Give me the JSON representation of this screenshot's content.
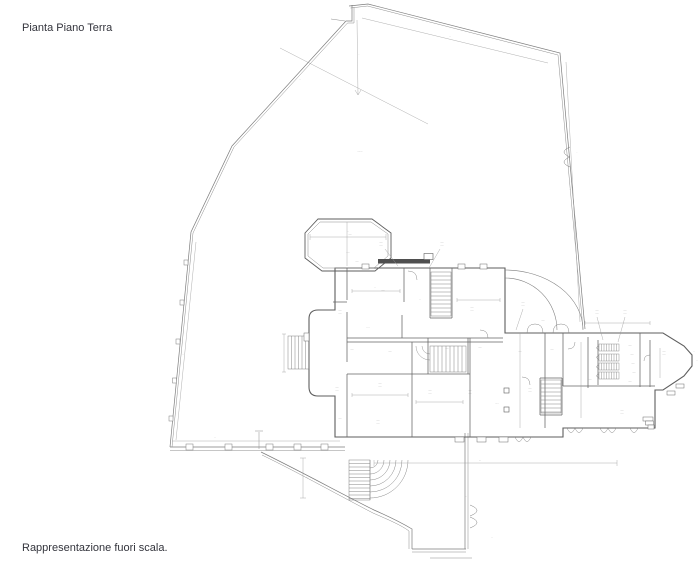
{
  "header": {
    "title": "Pianta Piano Terra"
  },
  "footer": {
    "note": "Rappresentazione fuori scala."
  },
  "drawing": {
    "kind": "architectural-ground-floor-plan",
    "ink": "#6b6b6b",
    "thin": "#9a9a9a",
    "label_ink": "#555555",
    "width": 700,
    "height": 567,
    "elements": [
      {
        "type": "pl",
        "p": "349,6 368,4 560,53 585,329",
        "w": 0.7,
        "c": "#7d7d7d"
      },
      {
        "type": "pl",
        "p": "350.5,8 367.5,6 558,55 583,329",
        "w": 0.5,
        "c": "#8d8d8d"
      },
      {
        "type": "pl",
        "p": "352,5 352,21 346,21 232,146 191,232 170,447",
        "w": 0.7,
        "c": "#7d7d7d"
      },
      {
        "type": "pl",
        "p": "354,7 354,23 347.5,23 234,147 193,233 172,447",
        "w": 0.5,
        "c": "#8d8d8d"
      },
      {
        "type": "pl",
        "p": "170,447 345,447",
        "w": 0.7,
        "c": "#7d7d7d"
      },
      {
        "type": "pl",
        "p": "170,450.5 345,450.5",
        "w": 0.5,
        "c": "#8d8d8d"
      },
      {
        "type": "pl",
        "p": "331,19 345,21",
        "w": 0.5,
        "c": "#8d8d8d"
      },
      {
        "type": "pl",
        "p": "465,433 465,549",
        "w": 0.7,
        "c": "#7d7d7d"
      },
      {
        "type": "pl",
        "p": "468,433 468,549",
        "w": 0.5,
        "c": "#8d8d8d"
      },
      {
        "type": "pl",
        "p": "412,549 466,549",
        "w": 0.7,
        "c": "#7d7d7d"
      },
      {
        "type": "pl",
        "p": "412,552 466,552",
        "w": 0.5,
        "c": "#8d8d8d"
      },
      {
        "type": "pl",
        "p": "430,558 472,558",
        "w": 0.5,
        "c": "#8d8d8d"
      },
      {
        "type": "pl",
        "p": "259,432 259,449",
        "w": 0.5,
        "c": "#8d8d8d"
      },
      {
        "type": "pl",
        "p": "255,431 263,431",
        "w": 0.5,
        "c": "#8d8d8d"
      },
      {
        "type": "pa",
        "d": "M261,452 C300,471 342,494 374,510 C390,517 402,523 412,529 L412,549",
        "w": 0.7,
        "c": "#7d7d7d"
      },
      {
        "type": "pa",
        "d": "M262,455 C301,474 342,497 373,513 C389,520 401,525 409,531 L409,549",
        "w": 0.5,
        "c": "#8d8d8d"
      },
      {
        "type": "pa",
        "d": "M570,147 Q558,152 570,157 M570,157 Q558,162 570,167",
        "w": 0.5,
        "c": "#7d7d7d"
      },
      {
        "type": "pa",
        "d": "M470,505 Q484,510.5 470,516 M470,517 Q484,522.5 470,528",
        "w": 0.5,
        "c": "#7d7d7d"
      },
      {
        "type": "r",
        "x": 184,
        "y": 260,
        "wd": 4,
        "ht": 5,
        "w": 0.5,
        "c": "#7d7d7d",
        "f": "#ffffff"
      },
      {
        "type": "r",
        "x": 180,
        "y": 300,
        "wd": 4,
        "ht": 5,
        "w": 0.5,
        "c": "#7d7d7d",
        "f": "#ffffff"
      },
      {
        "type": "r",
        "x": 176,
        "y": 339,
        "wd": 4,
        "ht": 5,
        "w": 0.5,
        "c": "#7d7d7d",
        "f": "#ffffff"
      },
      {
        "type": "r",
        "x": 172.5,
        "y": 378,
        "wd": 4,
        "ht": 5,
        "w": 0.5,
        "c": "#7d7d7d",
        "f": "#ffffff"
      },
      {
        "type": "r",
        "x": 169,
        "y": 416,
        "wd": 4,
        "ht": 5,
        "w": 0.5,
        "c": "#7d7d7d",
        "f": "#ffffff"
      },
      {
        "type": "r",
        "x": 186,
        "y": 444,
        "wd": 7,
        "ht": 6,
        "w": 0.5,
        "c": "#7d7d7d",
        "f": "#ffffff"
      },
      {
        "type": "r",
        "x": 225,
        "y": 444,
        "wd": 7,
        "ht": 6,
        "w": 0.5,
        "c": "#7d7d7d",
        "f": "#ffffff"
      },
      {
        "type": "r",
        "x": 266,
        "y": 444,
        "wd": 7,
        "ht": 6,
        "w": 0.5,
        "c": "#7d7d7d",
        "f": "#ffffff"
      },
      {
        "type": "r",
        "x": 294,
        "y": 444,
        "wd": 7,
        "ht": 6,
        "w": 0.5,
        "c": "#7d7d7d",
        "f": "#ffffff"
      },
      {
        "type": "r",
        "x": 321,
        "y": 444,
        "wd": 7,
        "ht": 6,
        "w": 0.5,
        "c": "#7d7d7d",
        "f": "#ffffff"
      },
      {
        "type": "pa",
        "d": "M335,268 L335,310 L318,310 Q309,310 309,319 L309,387 Q309,396 318,396 L335,396 L335,437 L563,437 L563,428 L655,428 L655,390 L663,390 L684,376 L692,366 L692,355 L684,346 L663,333 L505,333 L505,268 Z",
        "w": 1.1,
        "c": "#5e5e5e"
      },
      {
        "type": "pa",
        "d": "M318,219 L372,219 L391,233 L391,258 L375,271 L322,271 L305,258 L305,233 Z",
        "w": 0.9,
        "c": "#5e5e5e"
      },
      {
        "type": "pa",
        "d": "M320,222 L371,222 L388,234 L388,256 L374,268 L323,268 L308,256 L308,234 Z",
        "w": 0.5,
        "c": "#8d8d8d"
      },
      {
        "type": "r",
        "x": 378,
        "y": 259,
        "wd": 52,
        "ht": 4.5,
        "w": 0,
        "c": "none",
        "f": "#4f4f4f"
      },
      {
        "type": "r",
        "x": 424,
        "y": 253.5,
        "wd": 9,
        "ht": 6,
        "w": 0.6,
        "c": "#5e5e5e",
        "f": "#ffffff"
      },
      {
        "type": "pa",
        "d": "M347,268 L347,300 M347,312 L347,362 M347,374 L347,437 M404,268 L404,302 M402,315 L402,338 M430,268 L430,318 M452,268 L452,318 M430,318 L452,318 M428,338 L428,374 M468,338 L468,374 M412,342 L412,437 M470,338 L470,437 M545,333 L545,428 M563,333 L563,386 M588,337 L588,388 M598,340 L598,385 M640,333 L640,387 M650,340 L650,387 M347,338 L503,338 M347,342 L503,342 M333,302 L347,302 M347,374 L470,374 M563,386 L655,386 M540,378 L562,378 M540,415 L562,415 M540,378 L540,415 M562,378 L562,415",
        "w": 0.75,
        "c": "#666666"
      },
      {
        "type": "h",
        "x": 431,
        "y": 272,
        "wd": 20,
        "ht": 44,
        "s": 4,
        "dir": "h",
        "w": 0.45,
        "c": "#777777"
      },
      {
        "type": "h",
        "x": 430,
        "y": 346,
        "wd": 36,
        "ht": 26,
        "s": 4,
        "dir": "v",
        "w": 0.45,
        "c": "#777777"
      },
      {
        "type": "h",
        "x": 541,
        "y": 380,
        "wd": 20,
        "ht": 33,
        "s": 4,
        "dir": "h",
        "w": 0.45,
        "c": "#777777"
      },
      {
        "type": "h",
        "x": 288,
        "y": 336,
        "wd": 21,
        "ht": 33,
        "s": 3.5,
        "dir": "v",
        "w": 0.45,
        "c": "#777777"
      },
      {
        "type": "h",
        "x": 349,
        "y": 460,
        "wd": 21,
        "ht": 40,
        "s": 3.5,
        "dir": "h",
        "w": 0.45,
        "c": "#777777"
      },
      {
        "type": "h",
        "x": 599,
        "y": 344,
        "wd": 20,
        "ht": 7,
        "s": 2.5,
        "dir": "v",
        "w": 0.4,
        "c": "#777777"
      },
      {
        "type": "h",
        "x": 599,
        "y": 354,
        "wd": 20,
        "ht": 7,
        "s": 2.5,
        "dir": "v",
        "w": 0.4,
        "c": "#777777"
      },
      {
        "type": "h",
        "x": 599,
        "y": 363,
        "wd": 20,
        "ht": 7,
        "s": 2.5,
        "dir": "v",
        "w": 0.4,
        "c": "#777777"
      },
      {
        "type": "h",
        "x": 599,
        "y": 372,
        "wd": 20,
        "ht": 7,
        "s": 2.5,
        "dir": "v",
        "w": 0.4,
        "c": "#777777"
      },
      {
        "type": "pa",
        "d": "M370,468 A8,8 0 0 0 378,460 M370,474 A14,14 0 0 0 384,460 M370,480 A20,20 0 0 0 390,460 M370,486 A26,26 0 0 0 396,460 M370,492 A32,32 0 0 0 402,460 M370,498 A38,38 0 0 0 408,460 M370,460 L370,500",
        "w": 0.45,
        "c": "#7d7d7d"
      },
      {
        "type": "pa",
        "d": "M430,354 A8,8 0 0 1 422,346 M430,360 A14,14 0 0 1 416,346",
        "w": 0.4,
        "c": "#7d7d7d"
      },
      {
        "type": "pa",
        "d": "M505,270 A78,60 0 0 1 583,330 M505,278 A52,52 0 0 1 557,330",
        "w": 0.55,
        "c": "#7d7d7d"
      },
      {
        "type": "pa",
        "d": "M527,333 Q527,324 535,324 Q543,324 543,333 M553,333 Q553,324 561,324 Q569,324 569,333 M515,437 Q519,446 523,437 M523,437 Q527,446 531,437 M567,428 Q571,437 575,428 M575,428 Q579,437 583,428 M600,428 Q604,437 608,428 M608,428 Q612,437 616,428 M630,428 Q634,437 638,428 M408,271 Q417,271 417,280 M488,338 Q488,330 480,330 M530,385 Q530,377 522,377 M650,355 Q644,355 644,361 M575,342 Q575,349 568,349 M599,346 Q594,347.5 599,350 M599,355.5 Q594,357 599,359.5 M599,365 Q594,366.5 599,369 M599,374 Q594,375.5 599,378",
        "w": 0.45,
        "c": "#7d7d7d"
      },
      {
        "type": "r",
        "x": 504,
        "y": 388,
        "wd": 5,
        "ht": 5,
        "w": 0.6,
        "c": "#5e5e5e",
        "f": "#ffffff"
      },
      {
        "type": "r",
        "x": 504,
        "y": 407,
        "wd": 5,
        "ht": 5,
        "w": 0.6,
        "c": "#5e5e5e",
        "f": "#ffffff"
      },
      {
        "type": "r",
        "x": 362,
        "y": 264,
        "wd": 7,
        "ht": 5,
        "w": 0.5,
        "c": "#6b6b6b",
        "f": "#ffffff"
      },
      {
        "type": "r",
        "x": 458,
        "y": 264,
        "wd": 7,
        "ht": 5,
        "w": 0.5,
        "c": "#6b6b6b",
        "f": "#ffffff"
      },
      {
        "type": "r",
        "x": 480,
        "y": 264,
        "wd": 7,
        "ht": 5,
        "w": 0.5,
        "c": "#6b6b6b",
        "f": "#ffffff"
      },
      {
        "type": "r",
        "x": 455,
        "y": 437,
        "wd": 9,
        "ht": 5,
        "w": 0.5,
        "c": "#6b6b6b",
        "f": "#ffffff"
      },
      {
        "type": "r",
        "x": 477,
        "y": 437,
        "wd": 9,
        "ht": 5,
        "w": 0.5,
        "c": "#6b6b6b",
        "f": "#ffffff"
      },
      {
        "type": "r",
        "x": 499,
        "y": 437,
        "wd": 9,
        "ht": 5,
        "w": 0.5,
        "c": "#6b6b6b",
        "f": "#ffffff"
      },
      {
        "type": "r",
        "x": 304,
        "y": 333,
        "wd": 5,
        "ht": 8,
        "w": 0.5,
        "c": "#6b6b6b",
        "f": "#ffffff"
      },
      {
        "type": "r",
        "x": 643,
        "y": 417,
        "wd": 10,
        "ht": 4,
        "w": 0.5,
        "c": "#6b6b6b",
        "f": "#ffffff"
      },
      {
        "type": "r",
        "x": 645.5,
        "y": 421,
        "wd": 8,
        "ht": 4,
        "w": 0.5,
        "c": "#6b6b6b",
        "f": "#ffffff"
      },
      {
        "type": "r",
        "x": 648,
        "y": 425,
        "wd": 6,
        "ht": 4,
        "w": 0.5,
        "c": "#6b6b6b",
        "f": "#ffffff"
      },
      {
        "type": "r",
        "x": 667,
        "y": 391,
        "wd": 8,
        "ht": 4,
        "w": 0.5,
        "c": "#6b6b6b",
        "f": "#ffffff"
      },
      {
        "type": "r",
        "x": 676,
        "y": 384,
        "wd": 8,
        "ht": 4,
        "w": 0.5,
        "c": "#6b6b6b",
        "f": "#ffffff"
      },
      {
        "type": "pa",
        "d": "M374,460 L374,466 M374,463 L617,463 M617,460 L617,466 M303,458 L303,498 M300,458 L306,458 M300,498 L306,498 M310,234 L310,240 M310,237 L386,237 M386,234 L386,240 M347,222 L347,266 M352,289 L352,293 M352,291 L400,291 M400,289 L400,293 M457,298 L457,302 M457,300 L500,300 M500,298 L500,302 M352,393 L352,397 M352,395 L408,395 M408,393 L408,397 M416,400 L416,404 M416,402 L463,402 M463,400 L463,404 M585,321 L585,325 M585,323 L650,323 M650,321 L650,325 M520,333 L520,428 M581,342 L581,418 M660,348 L660,378 M280,48 L428,124 M357,20 L358,95 M355,90 L358,95 L361,90 M362,18 L548,63 M566,62 L580,322 M196,242 L176,440 M172,441 L340,441 M284,334 L284,372 M282,334 L286,334 M282,372 L286,372 M385,249 L398,266 M440,249 L429,268 M523,309 L516,330 M597,317 L603,340 M625,317 L618,342",
        "w": 0.4,
        "c": "#9a9a9a"
      },
      {
        "type": "t",
        "t": "··.··",
        "x": 350,
        "y": 235,
        "fs": 2.4
      },
      {
        "type": "t",
        "t": "·····",
        "x": 348,
        "y": 253,
        "fs": 2.4
      },
      {
        "type": "t",
        "t": "··",
        "x": 348,
        "y": 232,
        "fs": 2.2
      },
      {
        "type": "t",
        "t": "··.··",
        "x": 357,
        "y": 262,
        "fs": 2.4
      },
      {
        "type": "t",
        "t": "··.··",
        "x": 381,
        "y": 243,
        "fs": 2.4
      },
      {
        "type": "t",
        "t": "·····",
        "x": 381,
        "y": 246.5,
        "fs": 2.4
      },
      {
        "type": "t",
        "t": "··.··",
        "x": 442,
        "y": 243,
        "fs": 2.4
      },
      {
        "type": "t",
        "t": "·····",
        "x": 442,
        "y": 246.5,
        "fs": 2.4
      },
      {
        "type": "t",
        "t": "··.··",
        "x": 340,
        "y": 311,
        "fs": 2.4
      },
      {
        "type": "t",
        "t": "·····",
        "x": 340,
        "y": 314.5,
        "fs": 2.4
      },
      {
        "type": "t",
        "t": "··.··",
        "x": 383,
        "y": 291,
        "fs": 2.4
      },
      {
        "type": "t",
        "t": "··",
        "x": 420,
        "y": 300,
        "fs": 2.2
      },
      {
        "type": "t",
        "t": "··.··",
        "x": 472,
        "y": 308,
        "fs": 2.4
      },
      {
        "type": "t",
        "t": "·····",
        "x": 472,
        "y": 311.5,
        "fs": 2.4
      },
      {
        "type": "t",
        "t": "····",
        "x": 368,
        "y": 328,
        "fs": 2.4
      },
      {
        "type": "t",
        "t": "··.··",
        "x": 352,
        "y": 350,
        "fs": 2.4
      },
      {
        "type": "t",
        "t": "··.··",
        "x": 390,
        "y": 352,
        "fs": 2.4
      },
      {
        "type": "t",
        "t": "··.··",
        "x": 447,
        "y": 349,
        "fs": 2.4
      },
      {
        "type": "t",
        "t": "··.··",
        "x": 480,
        "y": 348,
        "fs": 2.4
      },
      {
        "type": "t",
        "t": "··.··",
        "x": 337,
        "y": 388,
        "fs": 2.4
      },
      {
        "type": "t",
        "t": "·····",
        "x": 337,
        "y": 391.5,
        "fs": 2.4
      },
      {
        "type": "t",
        "t": "··.··",
        "x": 380,
        "y": 384,
        "fs": 2.4
      },
      {
        "type": "t",
        "t": "·····",
        "x": 380,
        "y": 387.5,
        "fs": 2.4
      },
      {
        "type": "t",
        "t": "··.··",
        "x": 430,
        "y": 391,
        "fs": 2.4
      },
      {
        "type": "t",
        "t": "·····",
        "x": 430,
        "y": 394.5,
        "fs": 2.4
      },
      {
        "type": "t",
        "t": "··.··",
        "x": 470,
        "y": 391,
        "fs": 2.4
      },
      {
        "type": "t",
        "t": "·····",
        "x": 470,
        "y": 394.5,
        "fs": 2.4
      },
      {
        "type": "t",
        "t": "··.··",
        "x": 340,
        "y": 419,
        "fs": 2.4
      },
      {
        "type": "t",
        "t": "··.··",
        "x": 378,
        "y": 421,
        "fs": 2.4
      },
      {
        "type": "t",
        "t": "·····",
        "x": 378,
        "y": 424.5,
        "fs": 2.4
      },
      {
        "type": "t",
        "t": "·.··",
        "x": 497,
        "y": 404,
        "fs": 2.4
      },
      {
        "type": "t",
        "t": "··.··",
        "x": 523,
        "y": 303,
        "fs": 2.4
      },
      {
        "type": "t",
        "t": "·····",
        "x": 523,
        "y": 306.5,
        "fs": 2.4
      },
      {
        "type": "t",
        "t": "··.··",
        "x": 543,
        "y": 321,
        "fs": 2.4
      },
      {
        "type": "t",
        "t": "··.··",
        "x": 520,
        "y": 352,
        "fs": 2.4
      },
      {
        "type": "t",
        "t": "··.··",
        "x": 552,
        "y": 350,
        "fs": 2.4
      },
      {
        "type": "t",
        "t": "··.··",
        "x": 530,
        "y": 389,
        "fs": 2.4
      },
      {
        "type": "t",
        "t": "·····",
        "x": 530,
        "y": 392.5,
        "fs": 2.4
      },
      {
        "type": "t",
        "t": "··.··",
        "x": 597,
        "y": 311,
        "fs": 2.4
      },
      {
        "type": "t",
        "t": "·····",
        "x": 597,
        "y": 314.5,
        "fs": 2.4
      },
      {
        "type": "t",
        "t": "··.··",
        "x": 625,
        "y": 311,
        "fs": 2.4
      },
      {
        "type": "t",
        "t": "·····",
        "x": 625,
        "y": 314.5,
        "fs": 2.4
      },
      {
        "type": "t",
        "t": "··.··",
        "x": 630,
        "y": 346,
        "fs": 2.3
      },
      {
        "type": "t",
        "t": "··.··",
        "x": 632,
        "y": 355,
        "fs": 2.3
      },
      {
        "type": "t",
        "t": "··.··",
        "x": 633,
        "y": 364,
        "fs": 2.3
      },
      {
        "type": "t",
        "t": "··.··",
        "x": 634,
        "y": 373,
        "fs": 2.3
      },
      {
        "type": "t",
        "t": "··.··",
        "x": 630,
        "y": 382,
        "fs": 2.3
      },
      {
        "type": "t",
        "t": "··.··",
        "x": 590,
        "y": 380,
        "fs": 2.3
      },
      {
        "type": "t",
        "t": "··.··",
        "x": 664,
        "y": 352,
        "fs": 2.4
      },
      {
        "type": "t",
        "t": "·····",
        "x": 664,
        "y": 355.5,
        "fs": 2.4
      },
      {
        "type": "t",
        "t": "··.··",
        "x": 622,
        "y": 411,
        "fs": 2.4
      },
      {
        "type": "t",
        "t": "·····",
        "x": 622,
        "y": 414.5,
        "fs": 2.4
      },
      {
        "type": "t",
        "t": "··",
        "x": 694,
        "y": 352,
        "fs": 2.2
      },
      {
        "type": "t",
        "t": "··",
        "x": 697,
        "y": 361,
        "fs": 2.2
      },
      {
        "type": "t",
        "t": "···",
        "x": 480,
        "y": 461,
        "fs": 2.2
      },
      {
        "type": "t",
        "t": "··",
        "x": 466,
        "y": 497,
        "fs": 2.2
      },
      {
        "type": "t",
        "t": "··",
        "x": 492,
        "y": 538,
        "fs": 2.2
      },
      {
        "type": "t",
        "t": "··",
        "x": 307,
        "y": 478,
        "fs": 2.2
      },
      {
        "type": "t",
        "t": "··",
        "x": 215,
        "y": 438,
        "fs": 2.2
      },
      {
        "type": "t",
        "t": "··.···",
        "x": 360,
        "y": 152,
        "fs": 2.6
      },
      {
        "type": "t",
        "t": "··",
        "x": 300,
        "y": 80,
        "fs": 2.2
      },
      {
        "type": "t",
        "t": "··",
        "x": 450,
        "y": 37,
        "fs": 2.2
      },
      {
        "type": "t",
        "t": "··",
        "x": 570,
        "y": 190,
        "fs": 2.2
      },
      {
        "type": "t",
        "t": "··",
        "x": 183,
        "y": 355,
        "fs": 2.2
      },
      {
        "type": "t",
        "t": "·",
        "x": 577,
        "y": 153,
        "fs": 2.2
      },
      {
        "type": "t",
        "t": "·",
        "x": 359,
        "y": 55,
        "fs": 2.2
      },
      {
        "type": "t",
        "t": "··",
        "x": 375,
        "y": 288,
        "fs": 2.2
      }
    ]
  }
}
